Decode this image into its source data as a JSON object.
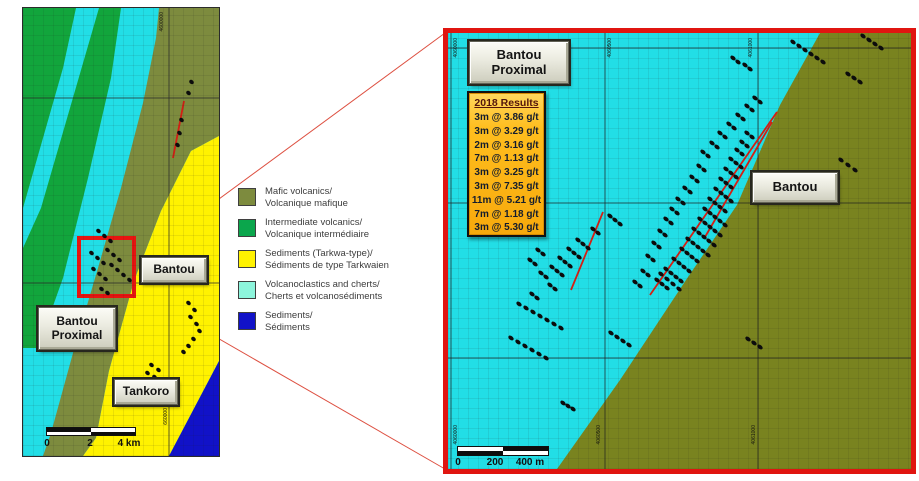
{
  "colors": {
    "map_green": "#12a53c",
    "map_cyan": "#22dee6",
    "map_olive": "#7d8b3e",
    "panel_olive": "#79831f",
    "map_yellow": "#fff200",
    "map_blue": "#1112c8",
    "highlight_red": "#e81410",
    "legend_cyan": "#8df5dc",
    "results_gold": "#ffbe1e"
  },
  "left_map": {
    "labels": {
      "bantou": "Bantou",
      "bantou_proximal_line1": "Bantou",
      "bantou_proximal_line2": "Proximal",
      "tankoro": "Tankoro"
    },
    "scale": {
      "ticks": [
        "0",
        "2",
        "4 km"
      ]
    },
    "coord_labels": {
      "top": "4600000",
      "bottom": "660000"
    },
    "dots": [
      [
        166,
        72
      ],
      [
        163,
        83
      ],
      [
        156,
        110
      ],
      [
        154,
        123
      ],
      [
        152,
        135
      ],
      [
        73,
        221
      ],
      [
        79,
        226
      ],
      [
        85,
        231
      ],
      [
        66,
        243
      ],
      [
        72,
        248
      ],
      [
        78,
        253
      ],
      [
        68,
        259
      ],
      [
        74,
        264
      ],
      [
        80,
        269
      ],
      [
        86,
        255
      ],
      [
        92,
        260
      ],
      [
        82,
        240
      ],
      [
        88,
        245
      ],
      [
        94,
        250
      ],
      [
        76,
        279
      ],
      [
        82,
        283
      ],
      [
        98,
        265
      ],
      [
        104,
        270
      ],
      [
        163,
        293
      ],
      [
        169,
        300
      ],
      [
        165,
        307
      ],
      [
        171,
        314
      ],
      [
        174,
        321
      ],
      [
        168,
        329
      ],
      [
        163,
        336
      ],
      [
        158,
        342
      ],
      [
        126,
        355
      ],
      [
        133,
        360
      ],
      [
        129,
        367
      ],
      [
        136,
        371
      ],
      [
        122,
        363
      ]
    ],
    "red_lines": [
      {
        "x1": 161,
        "y1": 93,
        "x2": 150,
        "y2": 150
      }
    ]
  },
  "legend": {
    "items": [
      {
        "color": "#7d8b3e",
        "label_en": "Mafic volcanics/",
        "label_fr": "Volcanique mafique"
      },
      {
        "color": "#0ba64c",
        "label_en": "Intermediate volcanics/",
        "label_fr": "Volcanique intermédiaire"
      },
      {
        "color": "#fff200",
        "label_en": "Sediments (Tarkwa-type)/",
        "label_fr": "Sédiments de type Tarkwaien"
      },
      {
        "color": "#8df5dc",
        "label_en": "Volcanoclastics and cherts/",
        "label_fr": "Cherts et volcanosédiments"
      },
      {
        "color": "#1112c8",
        "label_en": "Sediments/",
        "label_fr": "Sédiments"
      }
    ]
  },
  "right_panel": {
    "labels": {
      "bantou_proximal_line1": "Bantou",
      "bantou_proximal_line2": "Proximal",
      "bantou": "Bantou"
    },
    "results": {
      "title": "2018 Results",
      "rows": [
        "3m @ 3.86 g/t",
        "3m @ 3.29 g/t",
        "2m @ 3.16 g/t",
        "7m @ 1.13 g/t",
        "3m @ 3.25 g/t",
        "3m @ 7.35 g/t",
        "11m @ 5.21 g/t",
        "7m @ 1.18 g/t",
        "3m @ 5.30 g/t"
      ]
    },
    "scale": {
      "ticks": [
        "0",
        "200",
        "400 m"
      ]
    },
    "coord_labels": {
      "top": [
        "4060000",
        "4060500",
        "4061000"
      ],
      "bottom": [
        "4060000",
        "4060500",
        "4061000"
      ]
    },
    "dot_strings": [
      {
        "x": 159,
        "y": 181,
        "n": 3
      },
      {
        "x": 142,
        "y": 194,
        "n": 2
      },
      {
        "x": 127,
        "y": 205,
        "n": 3
      },
      {
        "x": 118,
        "y": 214,
        "n": 3
      },
      {
        "x": 109,
        "y": 223,
        "n": 3
      },
      {
        "x": 101,
        "y": 232,
        "n": 3
      },
      {
        "x": 87,
        "y": 215,
        "n": 2
      },
      {
        "x": 79,
        "y": 225,
        "n": 2
      },
      {
        "x": 90,
        "y": 238,
        "n": 2
      },
      {
        "x": 99,
        "y": 250,
        "n": 2
      },
      {
        "x": 81,
        "y": 259,
        "n": 2
      },
      {
        "x": 210,
        "y": 239,
        "n": 4,
        "dx": 6,
        "dy": 5
      },
      {
        "x": 206,
        "y": 245,
        "n": 3
      },
      {
        "x": 215,
        "y": 234,
        "n": 4
      },
      {
        "x": 223,
        "y": 224,
        "n": 4
      },
      {
        "x": 231,
        "y": 214,
        "n": 4
      },
      {
        "x": 237,
        "y": 204,
        "n": 5
      },
      {
        "x": 243,
        "y": 194,
        "n": 5
      },
      {
        "x": 249,
        "y": 184,
        "n": 5
      },
      {
        "x": 254,
        "y": 174,
        "n": 5
      },
      {
        "x": 259,
        "y": 164,
        "n": 4
      },
      {
        "x": 265,
        "y": 154,
        "n": 4
      },
      {
        "x": 270,
        "y": 144,
        "n": 3
      },
      {
        "x": 275,
        "y": 134,
        "n": 3
      },
      {
        "x": 280,
        "y": 124,
        "n": 3
      },
      {
        "x": 286,
        "y": 115,
        "n": 2
      },
      {
        "x": 291,
        "y": 107,
        "n": 2
      },
      {
        "x": 296,
        "y": 98,
        "n": 2
      },
      {
        "x": 192,
        "y": 236,
        "n": 2
      },
      {
        "x": 184,
        "y": 247,
        "n": 2
      },
      {
        "x": 197,
        "y": 221,
        "n": 2
      },
      {
        "x": 203,
        "y": 208,
        "n": 2
      },
      {
        "x": 209,
        "y": 196,
        "n": 2
      },
      {
        "x": 215,
        "y": 184,
        "n": 2
      },
      {
        "x": 221,
        "y": 174,
        "n": 2
      },
      {
        "x": 227,
        "y": 164,
        "n": 2
      },
      {
        "x": 234,
        "y": 153,
        "n": 2
      },
      {
        "x": 241,
        "y": 142,
        "n": 2
      },
      {
        "x": 248,
        "y": 131,
        "n": 2
      },
      {
        "x": 252,
        "y": 117,
        "n": 2
      },
      {
        "x": 261,
        "y": 108,
        "n": 2
      },
      {
        "x": 269,
        "y": 98,
        "n": 2
      },
      {
        "x": 278,
        "y": 89,
        "n": 2
      },
      {
        "x": 287,
        "y": 80,
        "n": 2
      },
      {
        "x": 296,
        "y": 71,
        "n": 2
      },
      {
        "x": 304,
        "y": 63,
        "n": 2
      },
      {
        "x": 282,
        "y": 23,
        "n": 2
      },
      {
        "x": 294,
        "y": 30,
        "n": 2
      },
      {
        "x": 342,
        "y": 7,
        "n": 6,
        "dx": 6,
        "dy": 4
      },
      {
        "x": 397,
        "y": 39,
        "n": 3,
        "dx": 6,
        "dy": 4
      },
      {
        "x": 412,
        "y": 1,
        "n": 4,
        "dx": 6,
        "dy": 4
      },
      {
        "x": 390,
        "y": 125,
        "n": 3,
        "dx": 7,
        "dy": 5
      },
      {
        "x": 297,
        "y": 304,
        "n": 3,
        "dx": 6,
        "dy": 4
      },
      {
        "x": 68,
        "y": 269,
        "n": 7,
        "dx": 7,
        "dy": 4
      },
      {
        "x": 60,
        "y": 303,
        "n": 6,
        "dx": 7,
        "dy": 4
      },
      {
        "x": 160,
        "y": 298,
        "n": 4,
        "dx": 6,
        "dy": 4
      },
      {
        "x": 112,
        "y": 368,
        "n": 3,
        "dx": 5,
        "dy": 3
      }
    ],
    "red_lines": [
      {
        "x1": 155,
        "y1": 179,
        "x2": 123,
        "y2": 257
      },
      {
        "x1": 202,
        "y1": 262,
        "x2": 329,
        "y2": 79
      },
      {
        "x1": 257,
        "y1": 204,
        "x2": 324,
        "y2": 89
      }
    ]
  }
}
